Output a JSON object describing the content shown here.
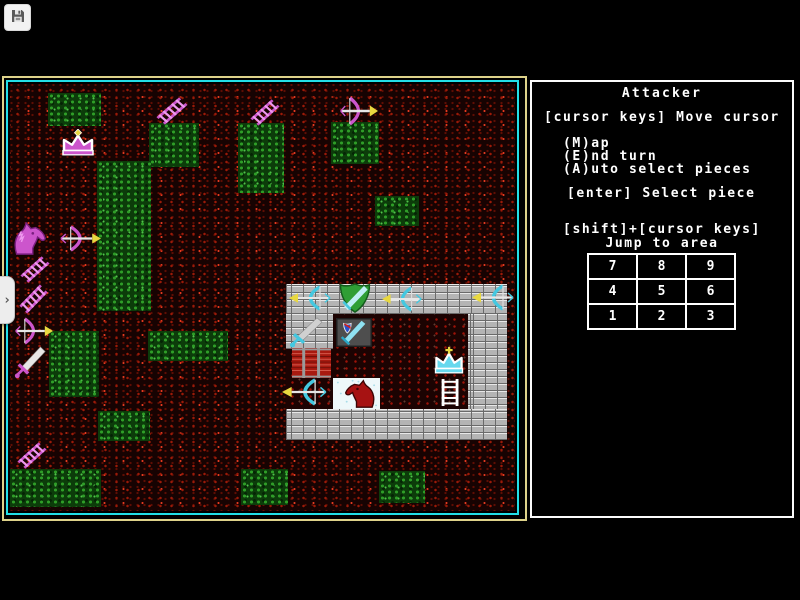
{
  "toolbar": {
    "save_icon": "floppy-disk"
  },
  "drawer": {
    "chevron": "›"
  },
  "panel": {
    "title": "Attacker",
    "hints": {
      "move": "[cursor keys] Move cursor",
      "map": "(M)ap",
      "end_turn": "(E)nd turn",
      "auto_select": "(A)uto select pieces",
      "select": "[enter] Select piece",
      "jump_keys": "[shift]+[cursor keys]",
      "jump_label": "Jump to area"
    },
    "jump_grid": {
      "rows": [
        [
          "7",
          "8",
          "9"
        ],
        [
          "4",
          "5",
          "6"
        ],
        [
          "1",
          "2",
          "3"
        ]
      ]
    }
  },
  "colors": {
    "frame_outer": "#ded28a",
    "frame_inner": "#22dfe8",
    "panel_border": "#fbfbfb",
    "attacker_primary": "#cc55cc",
    "attacker_light": "#ee99ee",
    "attacker_dark": "#7a1f80",
    "defender_primary": "#44c8e0",
    "defender_light": "#bfeef5",
    "arrow_gold": "#e8d840",
    "blade_silver": "#e6e6e6",
    "knight_red": "#a61212",
    "knight_red_dark": "#3c0404",
    "gate_red": "#a81a10",
    "gate_bar_gray": "#9a9a9a",
    "shield_green": "#2f9e35",
    "tile_gray": "#4e4e4e",
    "tile_white": "#eef8fa"
  },
  "board": {
    "green_patches": [
      {
        "x": 38,
        "y": 9,
        "w": 53,
        "h": 33
      },
      {
        "x": 139,
        "y": 39,
        "w": 50,
        "h": 44
      },
      {
        "x": 228,
        "y": 39,
        "w": 46,
        "h": 70
      },
      {
        "x": 321,
        "y": 38,
        "w": 48,
        "h": 42
      },
      {
        "x": 365,
        "y": 112,
        "w": 44,
        "h": 30
      },
      {
        "x": 87,
        "y": 77,
        "w": 54,
        "h": 150
      },
      {
        "x": 39,
        "y": 247,
        "w": 50,
        "h": 66
      },
      {
        "x": 138,
        "y": 247,
        "w": 80,
        "h": 30
      },
      {
        "x": 88,
        "y": 327,
        "w": 52,
        "h": 30
      },
      {
        "x": 0,
        "y": 385,
        "w": 91,
        "h": 38
      },
      {
        "x": 231,
        "y": 385,
        "w": 47,
        "h": 36
      },
      {
        "x": 369,
        "y": 387,
        "w": 46,
        "h": 32
      }
    ],
    "castle": {
      "floor": {
        "x": 276,
        "y": 230,
        "w": 182,
        "h": 95
      },
      "walls": [
        {
          "x": 276,
          "y": 200,
          "w": 221,
          "h": 30
        },
        {
          "x": 276,
          "y": 230,
          "w": 47,
          "h": 35
        },
        {
          "x": 458,
          "y": 230,
          "w": 39,
          "h": 126
        },
        {
          "x": 276,
          "y": 325,
          "w": 221,
          "h": 31
        }
      ]
    },
    "pieces": [
      {
        "name": "attacker-crown",
        "type": "crown-m",
        "x": 48,
        "y": 45,
        "w": 40,
        "h": 30
      },
      {
        "name": "attacker-ladder",
        "type": "ladder-m",
        "x": 146,
        "y": 13,
        "w": 32,
        "h": 28
      },
      {
        "name": "attacker-ladder",
        "type": "ladder-m",
        "x": 240,
        "y": 15,
        "w": 30,
        "h": 27
      },
      {
        "name": "attacker-bow",
        "type": "bow-m",
        "x": 328,
        "y": 12,
        "w": 40,
        "h": 30
      },
      {
        "name": "attacker-knight",
        "type": "horse-m",
        "x": 0,
        "y": 138,
        "w": 38,
        "h": 34
      },
      {
        "name": "attacker-bow",
        "type": "bow-m",
        "x": 48,
        "y": 141,
        "w": 43,
        "h": 27
      },
      {
        "name": "attacker-ladder",
        "type": "ladder-m",
        "x": 10,
        "y": 172,
        "w": 30,
        "h": 27
      },
      {
        "name": "attacker-ladder",
        "type": "ladder-m",
        "x": 9,
        "y": 200,
        "w": 29,
        "h": 30
      },
      {
        "name": "attacker-bow",
        "type": "bow-m",
        "x": 3,
        "y": 233,
        "w": 40,
        "h": 28
      },
      {
        "name": "attacker-sword",
        "type": "sword-m",
        "x": 4,
        "y": 262,
        "w": 34,
        "h": 33
      },
      {
        "name": "attacker-ladder",
        "type": "ladder-m",
        "x": 7,
        "y": 358,
        "w": 30,
        "h": 27
      },
      {
        "name": "defender-bow",
        "type": "bow-c",
        "x": 279,
        "y": 201,
        "w": 44,
        "h": 26
      },
      {
        "name": "defender-shield",
        "type": "shield-green",
        "x": 327,
        "y": 199,
        "w": 36,
        "h": 30
      },
      {
        "name": "defender-bow",
        "type": "bow-c",
        "x": 372,
        "y": 202,
        "w": 42,
        "h": 26
      },
      {
        "name": "defender-bow",
        "type": "bow-c",
        "x": 462,
        "y": 200,
        "w": 44,
        "h": 27
      },
      {
        "name": "defender-sword",
        "type": "sword-c",
        "x": 279,
        "y": 233,
        "w": 36,
        "h": 31
      },
      {
        "name": "defender-shield-tile",
        "type": "shield-tile",
        "x": 326,
        "y": 234,
        "w": 36,
        "h": 29
      },
      {
        "name": "defender-gate",
        "type": "portcullis",
        "x": 282,
        "y": 264,
        "w": 39,
        "h": 30
      },
      {
        "name": "defender-bow",
        "type": "bow-c",
        "x": 272,
        "y": 294,
        "w": 47,
        "h": 28
      },
      {
        "name": "defender-knight-tile",
        "type": "horse-tile",
        "x": 323,
        "y": 294,
        "w": 47,
        "h": 31
      },
      {
        "name": "defender-crown",
        "type": "crown-c",
        "x": 421,
        "y": 263,
        "w": 36,
        "h": 30
      },
      {
        "name": "defender-ladder",
        "type": "ladder-w",
        "x": 429,
        "y": 295,
        "w": 23,
        "h": 27
      }
    ]
  }
}
